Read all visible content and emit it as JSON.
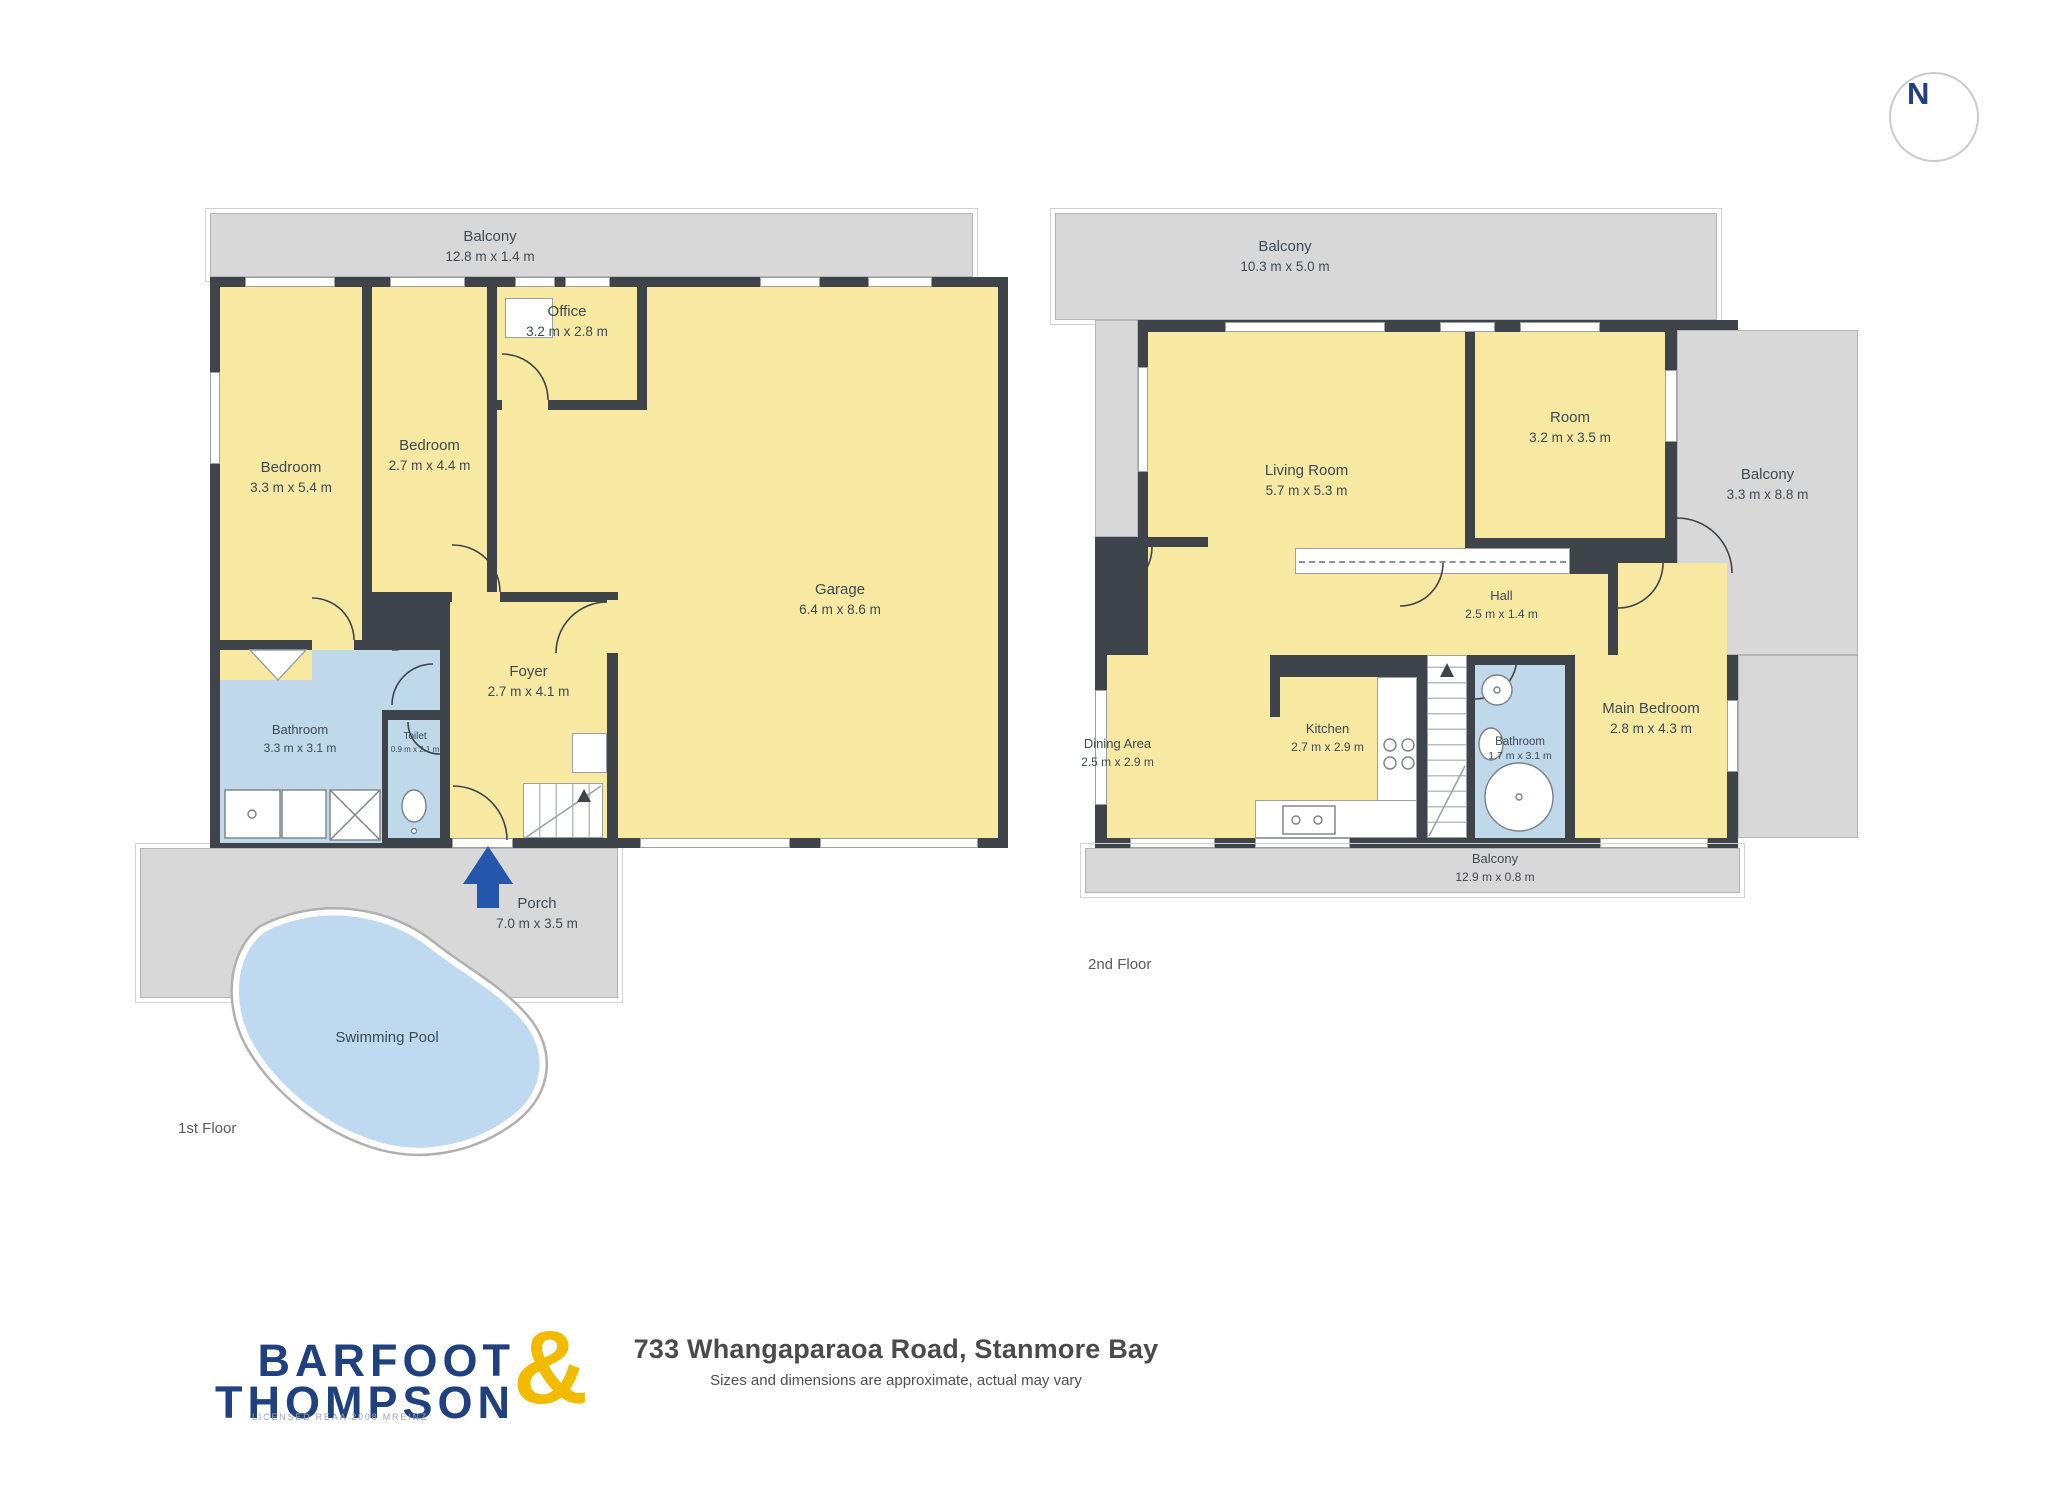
{
  "title": {
    "address": "733 Whangaparaoa Road, Stanmore Bay",
    "disclaimer": "Sizes and dimensions are approximate, actual may vary"
  },
  "logo": {
    "line1": "BARFOOT",
    "line2": "THOMPSON",
    "ampersand": "&",
    "license": "LICENSED REAA 2008 MREINZ"
  },
  "compass": {
    "letter": "N"
  },
  "floor1": {
    "label": "1st Floor",
    "rooms": [
      {
        "name": "Balcony",
        "dims": "12.8 m x 1.4 m"
      },
      {
        "name": "Bedroom",
        "dims": "3.3 m x 5.4 m"
      },
      {
        "name": "Bedroom",
        "dims": "2.7 m x 4.4 m"
      },
      {
        "name": "Office",
        "dims": "3.2 m x 2.8 m"
      },
      {
        "name": "Garage",
        "dims": "6.4 m x 8.6 m"
      },
      {
        "name": "Foyer",
        "dims": "2.7 m x 4.1 m"
      },
      {
        "name": "Bathroom",
        "dims": "3.3 m x 3.1 m"
      },
      {
        "name": "Toilet",
        "dims": "0.9 m x 2.1 m"
      },
      {
        "name": "Porch",
        "dims": "7.0 m x 3.5 m"
      },
      {
        "name": "Swimming Pool",
        "dims": ""
      }
    ]
  },
  "floor2": {
    "label": "2nd Floor",
    "rooms": [
      {
        "name": "Balcony",
        "dims": "10.3 m x 5.0 m"
      },
      {
        "name": "Living Room",
        "dims": "5.7 m x 5.3 m"
      },
      {
        "name": "Room",
        "dims": "3.2 m x 3.5 m"
      },
      {
        "name": "Balcony",
        "dims": "3.3 m x 8.8 m"
      },
      {
        "name": "Hall",
        "dims": "2.5 m x 1.4 m"
      },
      {
        "name": "Kitchen",
        "dims": "2.7 m x 2.9 m"
      },
      {
        "name": "Dining Area",
        "dims": "2.5 m x 2.9 m"
      },
      {
        "name": "Bathroom",
        "dims": "1.7 m x 3.1 m"
      },
      {
        "name": "Main Bedroom",
        "dims": "2.8 m x 4.3 m"
      },
      {
        "name": "Balcony",
        "dims": "12.9 m x 0.8 m"
      }
    ]
  },
  "colors": {
    "wall": "#3e444a",
    "room_yellow": "#f7e8a2",
    "wet_room_blue": "#bfd8ea",
    "balcony_gray": "#d8d8d8",
    "pool_blue": "#bed9f0",
    "entry_arrow_blue": "#2457ab",
    "logo_navy": "#20417f",
    "logo_yellow": "#f2bb00"
  }
}
